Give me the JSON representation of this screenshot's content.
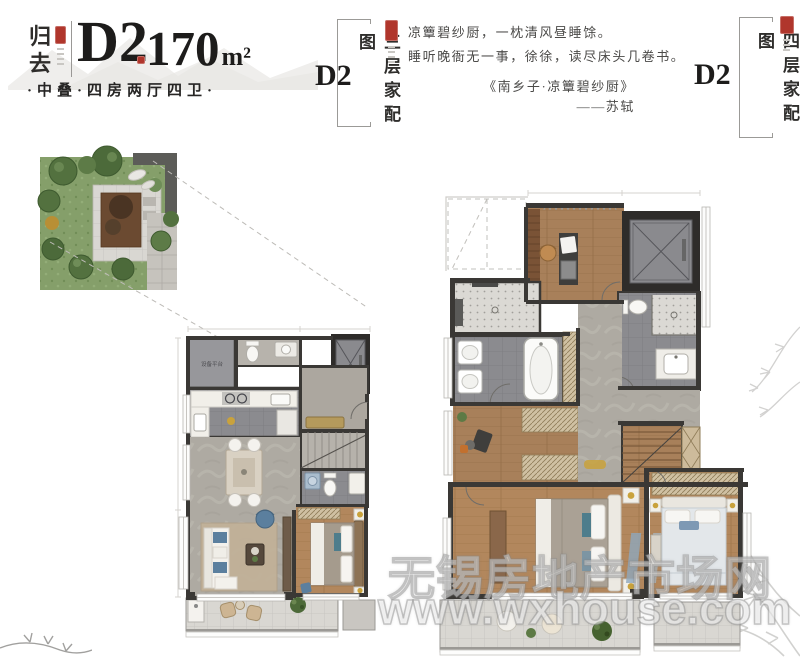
{
  "header": {
    "series_vertical": "归去",
    "unit_label": "D2",
    "area_number": "170",
    "area_unit": "m²",
    "subtitle": "·中叠·四房两厅四卫·"
  },
  "floor3_label": {
    "unit": "D2",
    "caption": "三层家配图"
  },
  "floor4_label": {
    "unit": "D2",
    "caption": "四层家配图"
  },
  "poem": {
    "line1": "凉簟碧纱厨，一枕清风昼睡馀。",
    "line2": "睡听晚衙无一事，徐徐，读尽床头几卷书。",
    "source": "《南乡子·凉簟碧纱厨》",
    "author": "——苏轼"
  },
  "floor3_plan": {
    "equipment_room_label": "设备平台"
  },
  "watermark": {
    "line1": "无锡房地产市场网",
    "line2": "www.wxhouse.com"
  },
  "icons": [
    "elevator-icon",
    "stairs-icon",
    "toilet-icon",
    "bathtub-icon",
    "shower-icon",
    "sink-icon",
    "bed-icon",
    "sofa-icon",
    "dining-table-icon",
    "desk-icon",
    "wardrobe-icon",
    "tree-icon",
    "plant-icon",
    "seal-stamp-icon",
    "pine-branch-icon"
  ],
  "colors": {
    "seal_red": "#b0362c",
    "ink": "#1d1c1b",
    "wall_dark": "#3a3835",
    "wood_floor": "#b2875d",
    "marble_floor": "#aeaaa2",
    "lawn_green": "#859f6a",
    "accent_gold": "#c9a23c",
    "accent_blue": "#5b7f9e"
  }
}
